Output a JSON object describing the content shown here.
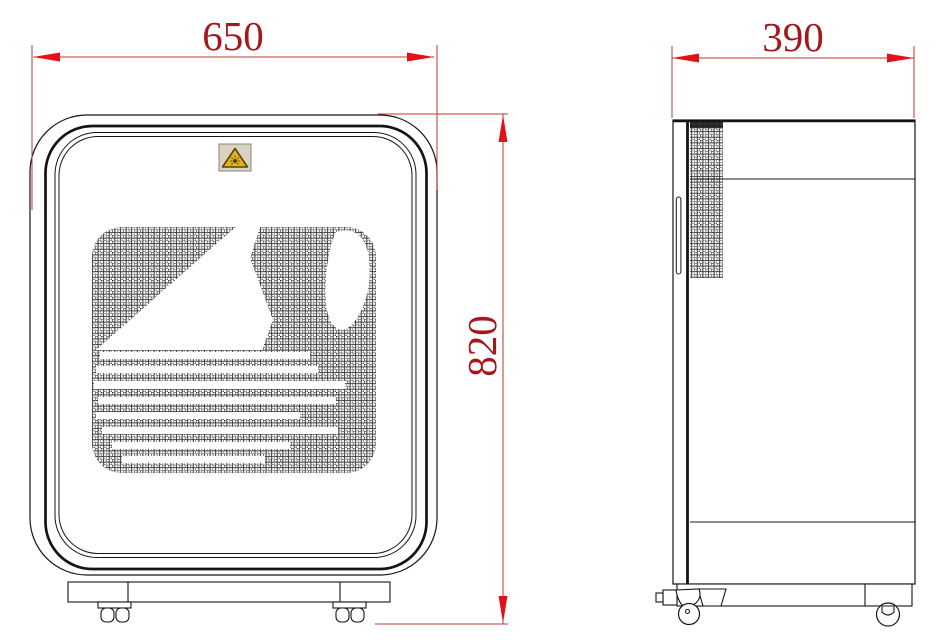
{
  "drawing": {
    "type": "technical-dimension-drawing",
    "background": "#ffffff",
    "line_color": "#141414",
    "dimension_style": {
      "line_color": "#c23632",
      "arrow_color": "#e41018",
      "text_color": "#a6171d"
    },
    "front_view": {
      "description": "front elevation of cabinet appliance with rounded door, perforated dot grille with wave logo, base plinth and twin casters",
      "warning_label": {
        "icon": "uv-warning-triangle-icon",
        "bg_color": "#d8d2c0",
        "triangle_fill": "#e3b21f",
        "triangle_stroke": "#574410"
      }
    },
    "side_view": {
      "description": "side elevation with front door edge, perforated vent band, handle slot, seam lines, plinth and swivel casters"
    },
    "dimensions": {
      "front_width": {
        "value": "650",
        "orientation": "horizontal",
        "view": "front"
      },
      "front_height": {
        "value": "820",
        "orientation": "vertical",
        "view": "front"
      },
      "side_depth": {
        "value": "390",
        "orientation": "horizontal",
        "view": "side"
      }
    }
  }
}
